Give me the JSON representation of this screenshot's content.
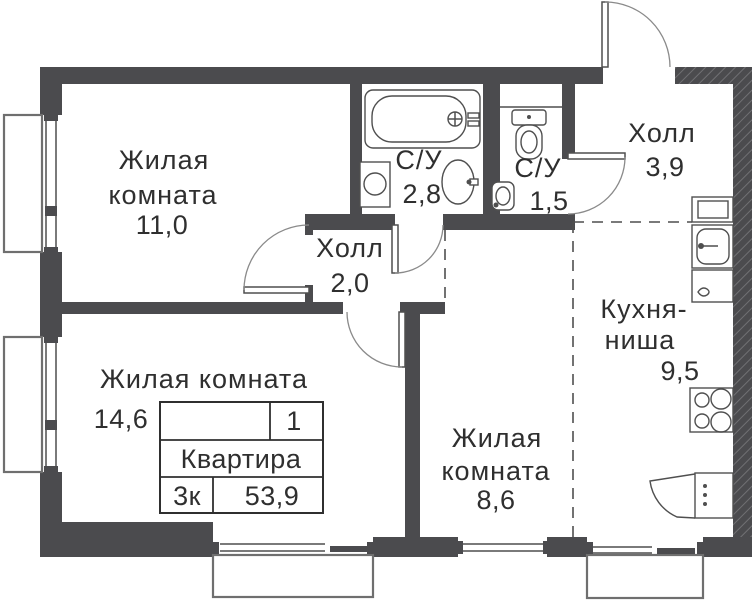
{
  "rooms": {
    "living_11": {
      "line1": "Жилая",
      "line2": "комната",
      "area": "11,0"
    },
    "living_14": {
      "line1": "Жилая комната",
      "area": "14,6"
    },
    "living_8": {
      "line1": "Жилая",
      "line2": "комната",
      "area": "8,6"
    },
    "hall_2": {
      "line1": "Холл",
      "area": "2,0"
    },
    "hall_39": {
      "line1": "Холл",
      "area": "3,9"
    },
    "wc_28": {
      "line1": "С/У",
      "area": "2,8"
    },
    "wc_15": {
      "line1": "С/У",
      "area": "1,5"
    },
    "kitchen": {
      "line1": "Кухня-",
      "line2": "ниша",
      "area": "9,5"
    }
  },
  "info_table": {
    "unit_number": "1",
    "label": "Квартира",
    "rooms_count": "3к",
    "total_area": "53,9"
  },
  "colors": {
    "wall": "#4b4b4e",
    "line": "#4f4f4f",
    "text": "#2f2f2f",
    "background": "#ffffff"
  }
}
